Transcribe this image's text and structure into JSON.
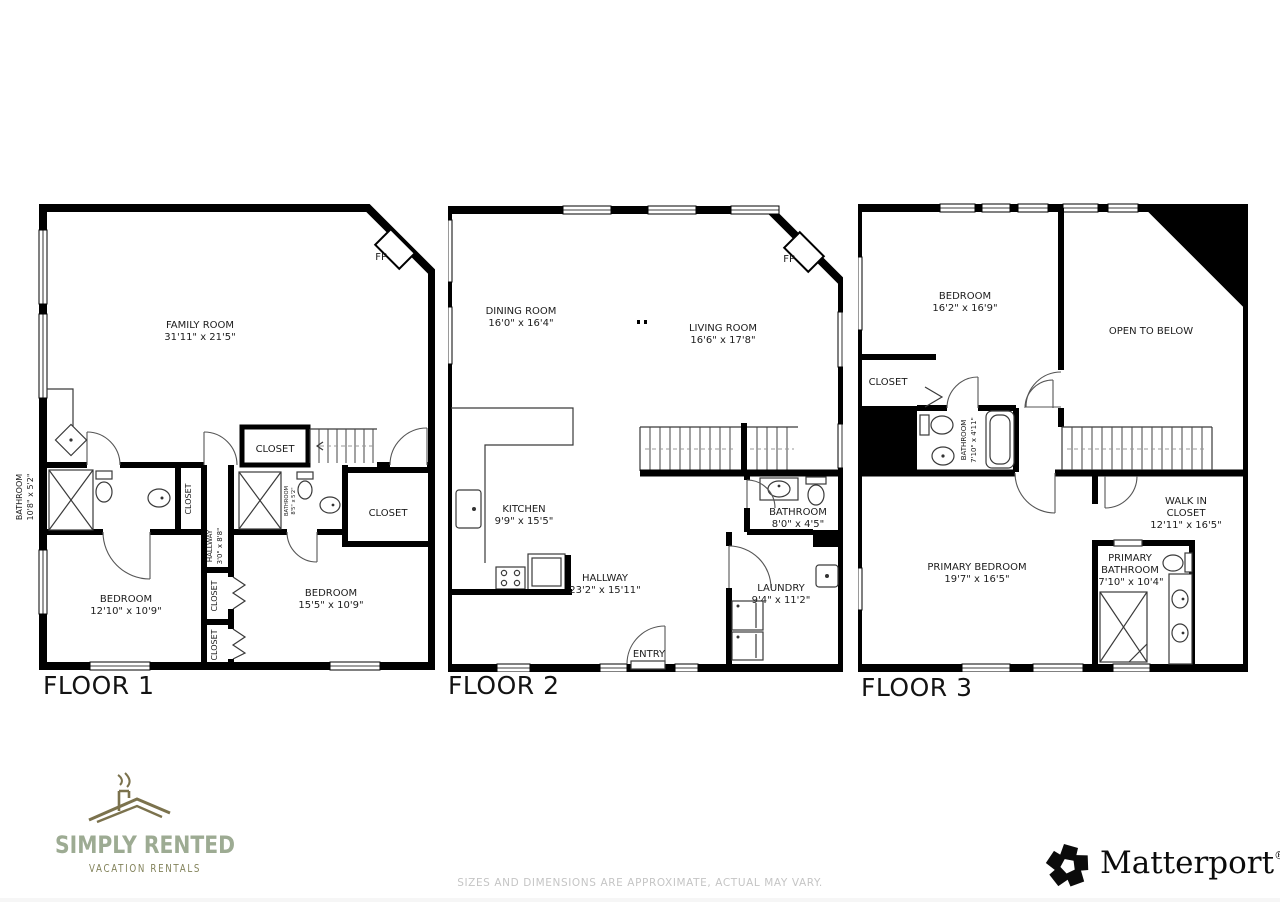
{
  "floors": {
    "f1": {
      "label": "FLOOR 1",
      "fp": "FP",
      "family_room": {
        "name": "FAMILY ROOM",
        "dims": "31'11\" x 21'5\""
      },
      "bath_left": {
        "name": "BATHROOM",
        "dims": "10'8\" x 5'2\""
      },
      "closet_top": "CLOSET",
      "closet_strip": "CLOSET",
      "hallway": {
        "name": "HALLWAY",
        "dims": "3'0\" x 8'8\""
      },
      "bath_small": {
        "name": "BATHROOM",
        "dims": "8'5\" x 5'2\""
      },
      "closet_right": "CLOSET",
      "bedroom_left": {
        "name": "BEDROOM",
        "dims": "12'10\" x 10'9\""
      },
      "bedroom_right": {
        "name": "BEDROOM",
        "dims": "15'5\" x 10'9\""
      },
      "closet_a": "CLOSET",
      "closet_b": "CLOSET"
    },
    "f2": {
      "label": "FLOOR 2",
      "fp": "FP",
      "dining": {
        "name": "DINING ROOM",
        "dims": "16'0\" x 16'4\""
      },
      "living": {
        "name": "LIVING ROOM",
        "dims": "16'6\" x 17'8\""
      },
      "kitchen": {
        "name": "KITCHEN",
        "dims": "9'9\" x 15'5\""
      },
      "hallway": {
        "name": "HALLWAY",
        "dims": "23'2\" x 15'11\""
      },
      "bathroom": {
        "name": "BATHROOM",
        "dims": "8'0\" x 4'5\""
      },
      "laundry": {
        "name": "LAUNDRY",
        "dims": "9'4\" x 11'2\""
      },
      "entry": "ENTRY"
    },
    "f3": {
      "label": "FLOOR 3",
      "bedroom": {
        "name": "BEDROOM",
        "dims": "16'2\" x 16'9\""
      },
      "open_below": "OPEN TO BELOW",
      "closet": "CLOSET",
      "bathroom": {
        "name": "BATHROOM",
        "dims": "7'10\" x 4'11\""
      },
      "primary_bedroom": {
        "name": "PRIMARY BEDROOM",
        "dims": "19'7\" x 16'5\""
      },
      "walk_in": {
        "l1": "WALK IN",
        "l2": "CLOSET",
        "dims": "12'11\" x 16'5\""
      },
      "primary_bath": {
        "l1": "PRIMARY",
        "l2": "BATHROOM",
        "dims": "7'10\" x 10'4\""
      }
    }
  },
  "branding": {
    "simply_rented": {
      "title": "SIMPLY RENTED",
      "subtitle": "VACATION RENTALS"
    },
    "matterport": {
      "name": "Matterport",
      "registered": "®"
    }
  },
  "footer": {
    "disclaimer": "SIZES AND DIMENSIONS ARE APPROXIMATE, ACTUAL MAY VARY."
  },
  "colors": {
    "wall": "#000000",
    "logo_green": "#9dab93",
    "logo_olive": "#7b724d",
    "disclaimer_gray": "#c5c5c5"
  }
}
